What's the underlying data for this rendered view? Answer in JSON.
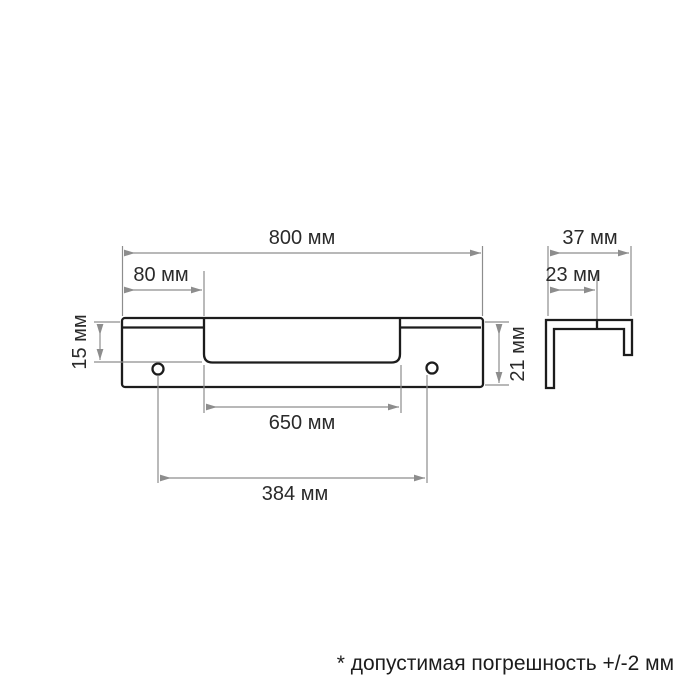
{
  "front_view": {
    "dims": {
      "width_total": "800 мм",
      "offset_left": "80 мм",
      "lip_height": "15 мм",
      "profile_height": "21 мм",
      "recess_width": "650 мм",
      "hole_spacing": "384 мм"
    }
  },
  "side_view": {
    "dims": {
      "depth_total": "37 мм",
      "depth_inner": "23 мм"
    }
  },
  "footnote": "* допустимая погрешность +/-2 мм",
  "colors": {
    "outline": "#1c1c1c",
    "dimension_lines": "#8d8d8d",
    "text": "#2a2a2a",
    "background": "#ffffff"
  }
}
